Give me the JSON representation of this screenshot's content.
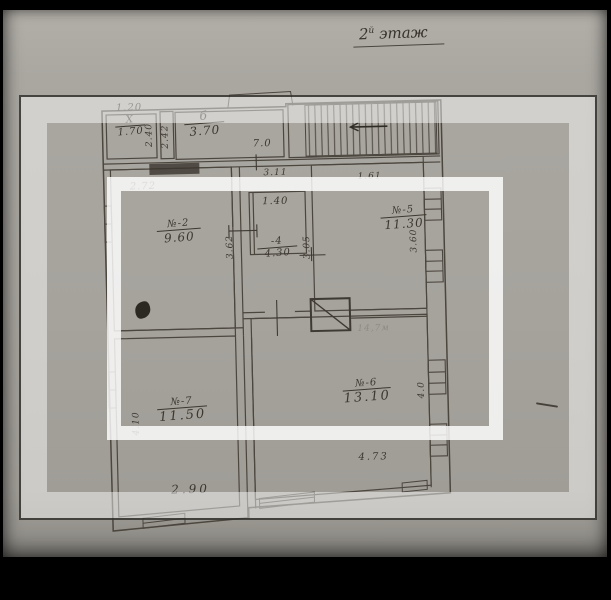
{
  "title": {
    "num": "2",
    "sup": "й",
    "word": "этаж"
  },
  "colors": {
    "paper": "#a6a39d",
    "ink": "#3c3830",
    "overlay_white": "#ffffff",
    "background": "#000000"
  },
  "rooms": {
    "closet": {
      "num": "Х",
      "area": "1.70"
    },
    "hall3": {
      "num": "б",
      "area": "3.70"
    },
    "room2": {
      "num": "№-2",
      "area": "9.60"
    },
    "room4": {
      "num": "-4",
      "area": "4.30"
    },
    "room5": {
      "num": "№-5",
      "area": "11.30"
    },
    "room6": {
      "num": "№-6",
      "area": "13.10"
    },
    "room7": {
      "num": "№-7",
      "area": "11.50"
    }
  },
  "dims": {
    "top_closet": "1.20",
    "closet_w": "2.40",
    "shaft_w": "2.42",
    "hall_w": "7.0",
    "room2_w": "2.72",
    "hall_top": "3.11",
    "room5_top": "1.61",
    "room4_w": "1.40",
    "room2_d": "3.62",
    "room4_d": "3.05",
    "room5_d": "3.60",
    "room7_d": "4.10",
    "room7_w": "2.90",
    "room6_d": "4.0",
    "room6_w": "4.73"
  },
  "notes": {
    "faint_note": "14,7м"
  },
  "icons": {
    "stairs": "staircase-with-direction-arrow",
    "chimney": "flue-square-with-diagonal",
    "ink_blob": "ink-spot"
  }
}
